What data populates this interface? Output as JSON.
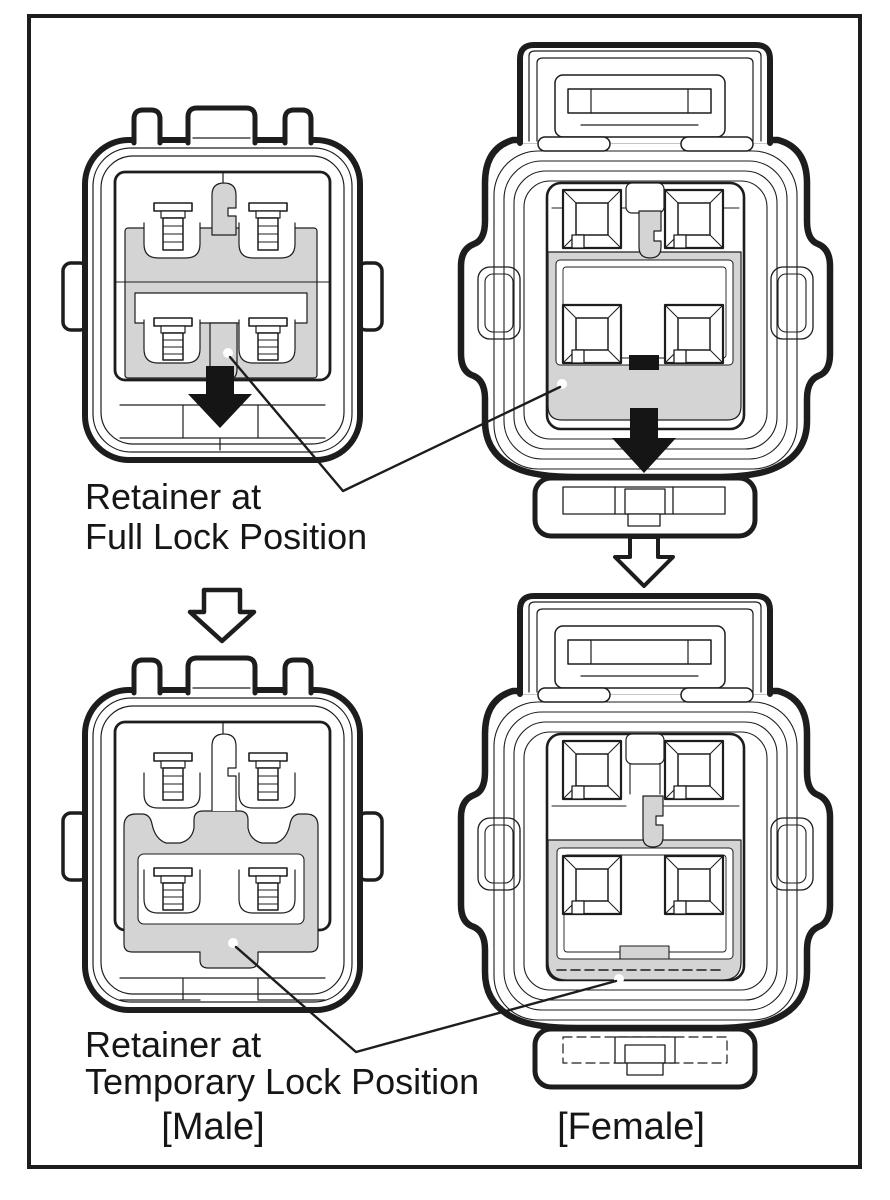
{
  "figure": {
    "title_implicit": "Connector retainer lock positions",
    "callout_full_lock": {
      "line1": "Retainer at",
      "line2": "Full Lock Position"
    },
    "callout_temporary_lock": {
      "line1": "Retainer at",
      "line2": "Temporary Lock Position"
    },
    "male_caption": "[Male]",
    "female_caption": "[Female]"
  },
  "icons": {
    "black_down_arrow": "push-direction-arrow-icon",
    "white_down_arrow": "transition-arrow-icon"
  },
  "colors": {
    "line": "#1d1d1d",
    "retainer_gray": "#d4d4d4",
    "arrow_black": "#151515",
    "background": "#ffffff"
  }
}
